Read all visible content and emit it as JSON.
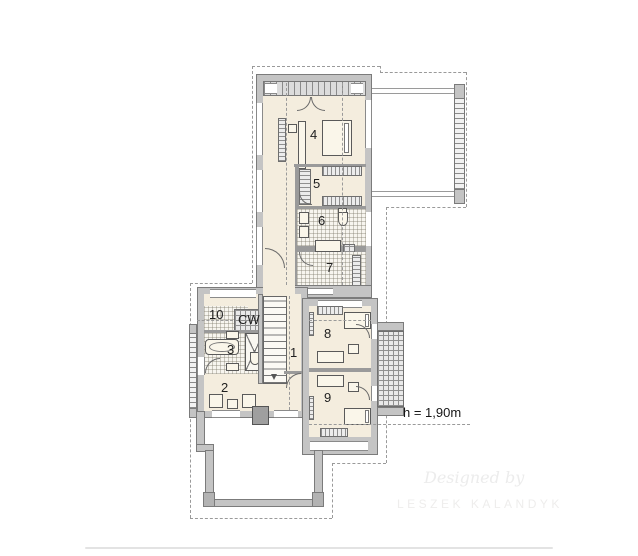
{
  "document": {
    "type": "floor-plan",
    "storey": "upper"
  },
  "rooms": {
    "r1": {
      "label": "1"
    },
    "r2": {
      "label": "2"
    },
    "r3": {
      "label": "3"
    },
    "r4": {
      "label": "4"
    },
    "r5": {
      "label": "5"
    },
    "r6": {
      "label": "6"
    },
    "r7": {
      "label": "7"
    },
    "r8": {
      "label": "8"
    },
    "r9": {
      "label": "9"
    },
    "r10": {
      "label": "10"
    },
    "cw": {
      "label": "CW"
    }
  },
  "annotations": {
    "height_note": "h = 1,90m"
  },
  "watermark": {
    "line1": "Designed by",
    "line2": "LESZEK KALANDYK"
  },
  "colors": {
    "floor": "#f4edde",
    "wall": "#c4c4c4",
    "wall_outline": "#7b7b7b",
    "dashed_line": "#9a9a9a",
    "label_text": "#1f1f1f",
    "annotation_text": "#161616",
    "watermark_text": "#ececec",
    "chimney": "#9f9f9f"
  }
}
